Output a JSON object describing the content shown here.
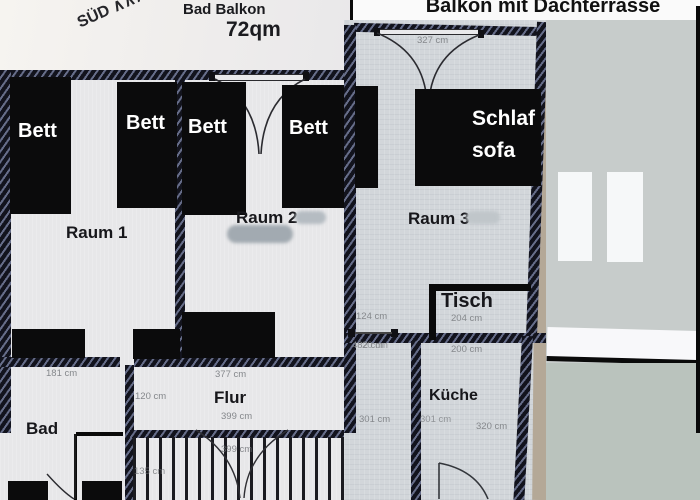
{
  "left_photo": {
    "compass_label": "SÜD ∧∧∧WEST",
    "balcony_label": "Bad Balkon",
    "area_label": "72qm",
    "room1_label": "Raum 1",
    "room2_label": "Raum 2",
    "bad_label": "Bad",
    "flur_label": "Flur",
    "beds": [
      "Bett",
      "Bett",
      "Bett",
      "Bett"
    ],
    "measurements": {
      "m181": "181 cm",
      "m377": "377 cm",
      "m120": "120 cm",
      "m399a": "399 cm",
      "m399b": "399 cm",
      "m135": "135 cm"
    }
  },
  "right_photo": {
    "title": "Balkon mit Dachterrasse",
    "room3_label": "Raum 3",
    "sofa_label_line1": "Schlaf",
    "sofa_label_line2": "sofa",
    "tisch_label": "Tisch",
    "kueche_label": "Küche",
    "measurements": {
      "m327": "327 cm",
      "m124": "124 cm",
      "m204": "204 cm",
      "m482": "482 cm",
      "m420": "20 cm",
      "m200": "200 cm",
      "m301a": "301 cm",
      "m301b": "301 cm",
      "m320": "320 cm"
    }
  },
  "colors": {
    "wall": "#12131d",
    "furniture": "#0b0b0c",
    "panel_gray": "#c7cccb",
    "panel_gray_lower": "#bac3bd",
    "black_edge": "#0a0a0a",
    "measure_text": "#85888c",
    "tan_edge": "#b4a897"
  }
}
